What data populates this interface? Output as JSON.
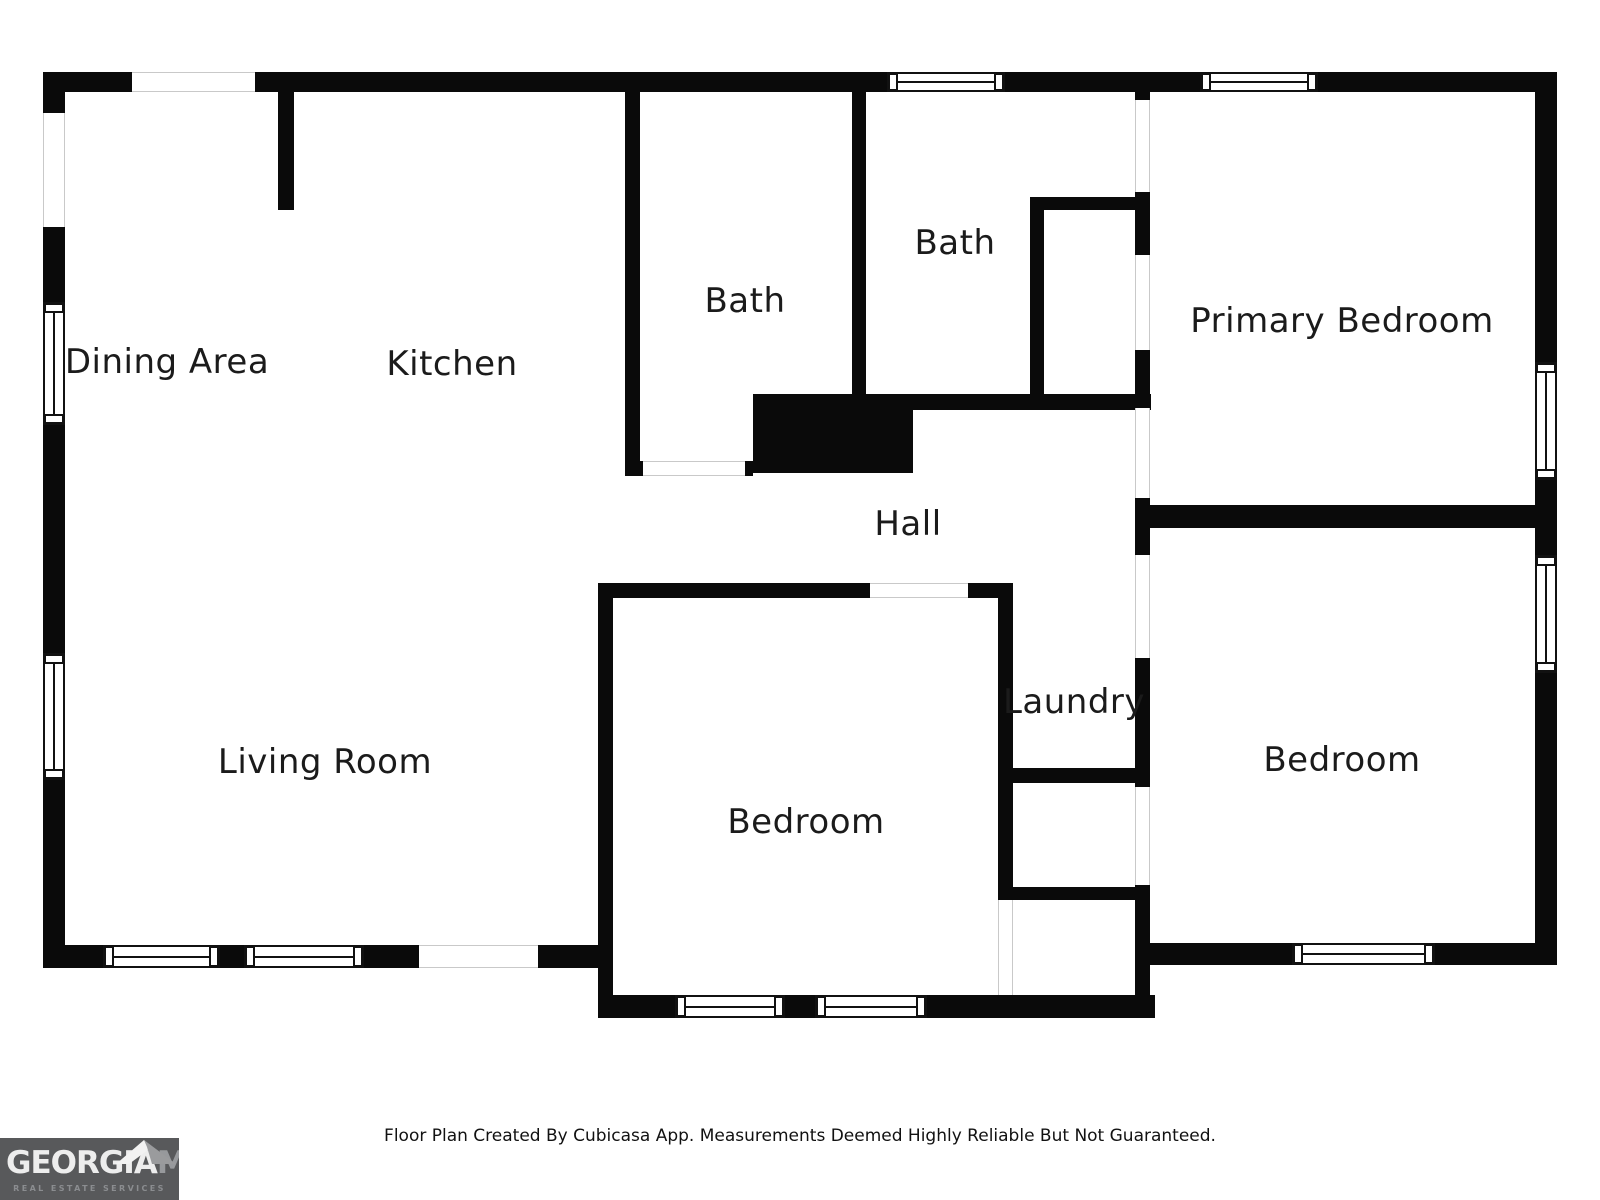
{
  "page": {
    "background": "#ffffff"
  },
  "footer": {
    "disclaimer": "Floor Plan Created By Cubicasa App. Measurements Deemed Highly Reliable But Not Guaranteed."
  },
  "logo": {
    "brand_primary": "GEORGIA",
    "brand_secondary": "MLS",
    "tagline": "REAL ESTATE SERVICES",
    "bg_color": "#58595b",
    "primary_color": "#ededed",
    "secondary_color": "#97999c",
    "tagline_color": "#8b8d90",
    "roof_left_color": "#f2f2f2",
    "roof_right_color": "#9a9b9d"
  },
  "floorplan": {
    "wall_color": "#0a0a0a",
    "label_color": "#1b1b1b",
    "rooms": [
      {
        "label": "Dining Area",
        "cx": 167,
        "cy": 362
      },
      {
        "label": "Kitchen",
        "cx": 452,
        "cy": 364
      },
      {
        "label": "Bath",
        "cx": 745,
        "cy": 301
      },
      {
        "label": "Bath",
        "cx": 955,
        "cy": 243
      },
      {
        "label": "Primary Bedroom",
        "cx": 1342,
        "cy": 321
      },
      {
        "label": "Hall",
        "cx": 908,
        "cy": 524
      },
      {
        "label": "Laundry",
        "cx": 1074,
        "cy": 702
      },
      {
        "label": "Bedroom",
        "cx": 806,
        "cy": 822
      },
      {
        "label": "Bedroom",
        "cx": 1342,
        "cy": 760
      },
      {
        "label": "Living Room",
        "cx": 325,
        "cy": 762
      }
    ],
    "walls": [
      {
        "x": 43,
        "y": 72,
        "w": 1514,
        "h": 20
      },
      {
        "x": 43,
        "y": 72,
        "w": 22,
        "h": 896
      },
      {
        "x": 1535,
        "y": 72,
        "w": 22,
        "h": 893
      },
      {
        "x": 43,
        "y": 945,
        "w": 570,
        "h": 23
      },
      {
        "x": 1148,
        "y": 943,
        "w": 409,
        "h": 22
      },
      {
        "x": 598,
        "y": 995,
        "w": 557,
        "h": 23
      },
      {
        "x": 598,
        "y": 583,
        "w": 15,
        "h": 435
      },
      {
        "x": 613,
        "y": 583,
        "w": 385,
        "h": 15
      },
      {
        "x": 998,
        "y": 583,
        "w": 15,
        "h": 417
      },
      {
        "x": 278,
        "y": 92,
        "w": 16,
        "h": 118
      },
      {
        "x": 625,
        "y": 92,
        "w": 15,
        "h": 384
      },
      {
        "x": 625,
        "y": 461,
        "w": 128,
        "h": 15
      },
      {
        "x": 753,
        "y": 394,
        "w": 160,
        "h": 79
      },
      {
        "x": 852,
        "y": 92,
        "w": 14,
        "h": 302
      },
      {
        "x": 913,
        "y": 394,
        "w": 238,
        "h": 16
      },
      {
        "x": 1030,
        "y": 197,
        "w": 14,
        "h": 213
      },
      {
        "x": 1030,
        "y": 197,
        "w": 120,
        "h": 13
      },
      {
        "x": 1135,
        "y": 92,
        "w": 15,
        "h": 8
      },
      {
        "x": 1135,
        "y": 192,
        "w": 15,
        "h": 63
      },
      {
        "x": 1135,
        "y": 350,
        "w": 15,
        "h": 58
      },
      {
        "x": 1135,
        "y": 498,
        "w": 15,
        "h": 57
      },
      {
        "x": 1135,
        "y": 658,
        "w": 15,
        "h": 129
      },
      {
        "x": 1135,
        "y": 885,
        "w": 15,
        "h": 133
      },
      {
        "x": 1150,
        "y": 505,
        "w": 385,
        "h": 23
      },
      {
        "x": 1013,
        "y": 768,
        "w": 137,
        "h": 15
      },
      {
        "x": 998,
        "y": 887,
        "w": 152,
        "h": 13
      }
    ],
    "openings": [
      {
        "x": 132,
        "y": 72,
        "w": 123,
        "h": 20,
        "o": "h"
      },
      {
        "x": 419,
        "y": 945,
        "w": 119,
        "h": 23,
        "o": "h"
      },
      {
        "x": 643,
        "y": 461,
        "w": 102,
        "h": 15,
        "o": "h"
      },
      {
        "x": 870,
        "y": 583,
        "w": 98,
        "h": 15,
        "o": "h"
      },
      {
        "x": 43,
        "y": 113,
        "w": 22,
        "h": 114,
        "o": "v"
      },
      {
        "x": 998,
        "y": 900,
        "w": 15,
        "h": 95,
        "o": "v"
      },
      {
        "x": 1135,
        "y": 100,
        "w": 15,
        "h": 92,
        "o": "v"
      },
      {
        "x": 1135,
        "y": 255,
        "w": 15,
        "h": 95,
        "o": "v"
      },
      {
        "x": 1135,
        "y": 408,
        "w": 15,
        "h": 90,
        "o": "v"
      },
      {
        "x": 1135,
        "y": 555,
        "w": 15,
        "h": 103,
        "o": "v"
      },
      {
        "x": 1135,
        "y": 787,
        "w": 15,
        "h": 98,
        "o": "v"
      }
    ],
    "windows": [
      {
        "x": 887,
        "y": 72,
        "w": 118,
        "h": 20,
        "o": "h"
      },
      {
        "x": 1200,
        "y": 72,
        "w": 118,
        "h": 20,
        "o": "h"
      },
      {
        "x": 103,
        "y": 945,
        "w": 117,
        "h": 23,
        "o": "h"
      },
      {
        "x": 244,
        "y": 945,
        "w": 120,
        "h": 23,
        "o": "h"
      },
      {
        "x": 675,
        "y": 995,
        "w": 110,
        "h": 23,
        "o": "h"
      },
      {
        "x": 815,
        "y": 995,
        "w": 112,
        "h": 23,
        "o": "h"
      },
      {
        "x": 1292,
        "y": 943,
        "w": 143,
        "h": 22,
        "o": "h"
      },
      {
        "x": 43,
        "y": 302,
        "w": 22,
        "h": 123,
        "o": "v"
      },
      {
        "x": 43,
        "y": 653,
        "w": 22,
        "h": 127,
        "o": "v"
      },
      {
        "x": 1535,
        "y": 362,
        "w": 22,
        "h": 118,
        "o": "v"
      },
      {
        "x": 1535,
        "y": 555,
        "w": 22,
        "h": 118,
        "o": "v"
      }
    ]
  }
}
